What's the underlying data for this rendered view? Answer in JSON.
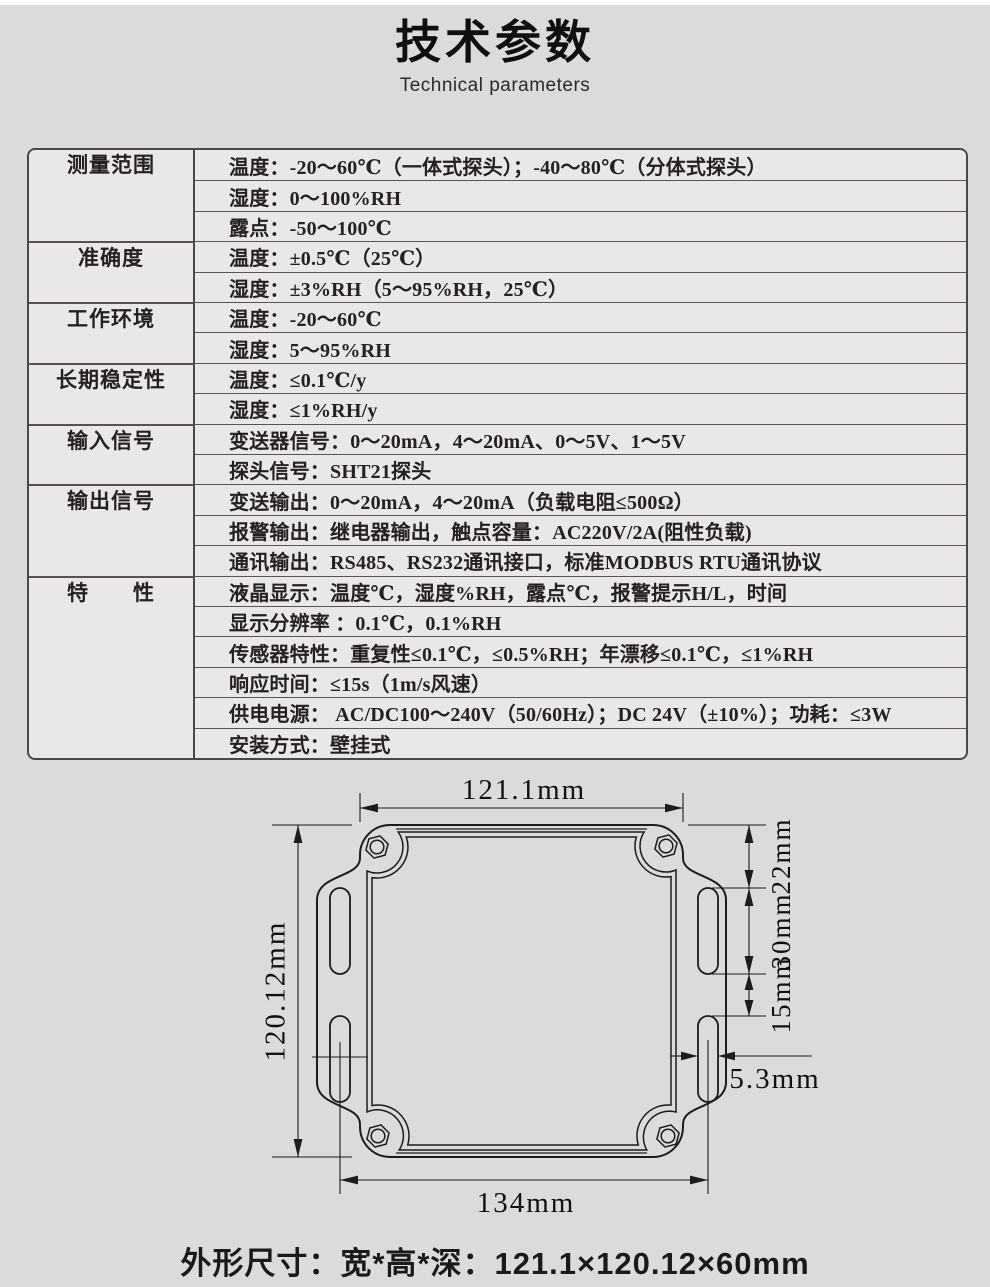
{
  "header": {
    "title": "技术参数",
    "subtitle": "Technical parameters"
  },
  "table": {
    "groups": [
      {
        "label": "测量范围",
        "rows": [
          "温度：-20～60℃（一体式探头）；-40～80℃（分体式探头）",
          "湿度：0～100%RH",
          "露点：-50～100℃"
        ]
      },
      {
        "label": "准确度",
        "rows": [
          "温度：±0.5℃（25℃）",
          "湿度：±3%RH（5～95%RH，25℃）"
        ]
      },
      {
        "label": "工作环境",
        "rows": [
          "温度：-20～60℃",
          "湿度：5～95%RH"
        ]
      },
      {
        "label": "长期稳定性",
        "rows": [
          "温度：≤0.1℃/y",
          "湿度：≤1%RH/y"
        ]
      },
      {
        "label": "输入信号",
        "rows": [
          "变送器信号：0～20mA，4～20mA、0～5V、1～5V",
          "探头信号：SHT21探头"
        ]
      },
      {
        "label": "输出信号",
        "rows": [
          "变送输出：0～20mA，4～20mA（负载电阻≤500Ω）",
          "报警输出：继电器输出，触点容量：AC220V/2A(阻性负载)",
          "通讯输出：RS485、RS232通讯接口，标准MODBUS RTU通讯协议"
        ]
      },
      {
        "label": "特　　性",
        "rows": [
          "液晶显示：温度℃，湿度%RH，露点℃，报警提示H/L，时间",
          "显示分辨率 ：0.1℃，0.1%RH",
          "传感器特性：重复性≤0.1℃，≤0.5%RH；年漂移≤0.1℃，≤1%RH",
          "响应时间：≤15s（1m/s风速）",
          "供电电源： AC/DC100～240V（50/60Hz）；DC 24V（±10%）；功耗：≤3W",
          "安装方式：壁挂式"
        ]
      }
    ]
  },
  "drawing": {
    "dims": {
      "top_width": "121.1mm",
      "left_height": "120.12mm",
      "right_top_offset": "22mm",
      "right_slot_length": "30mm",
      "right_slot_gap": "15mm",
      "slot_width": "5.3mm",
      "bottom_width": "134mm"
    }
  },
  "footer": {
    "caption": "外形尺寸：宽*高*深：121.1×120.12×60mm"
  }
}
